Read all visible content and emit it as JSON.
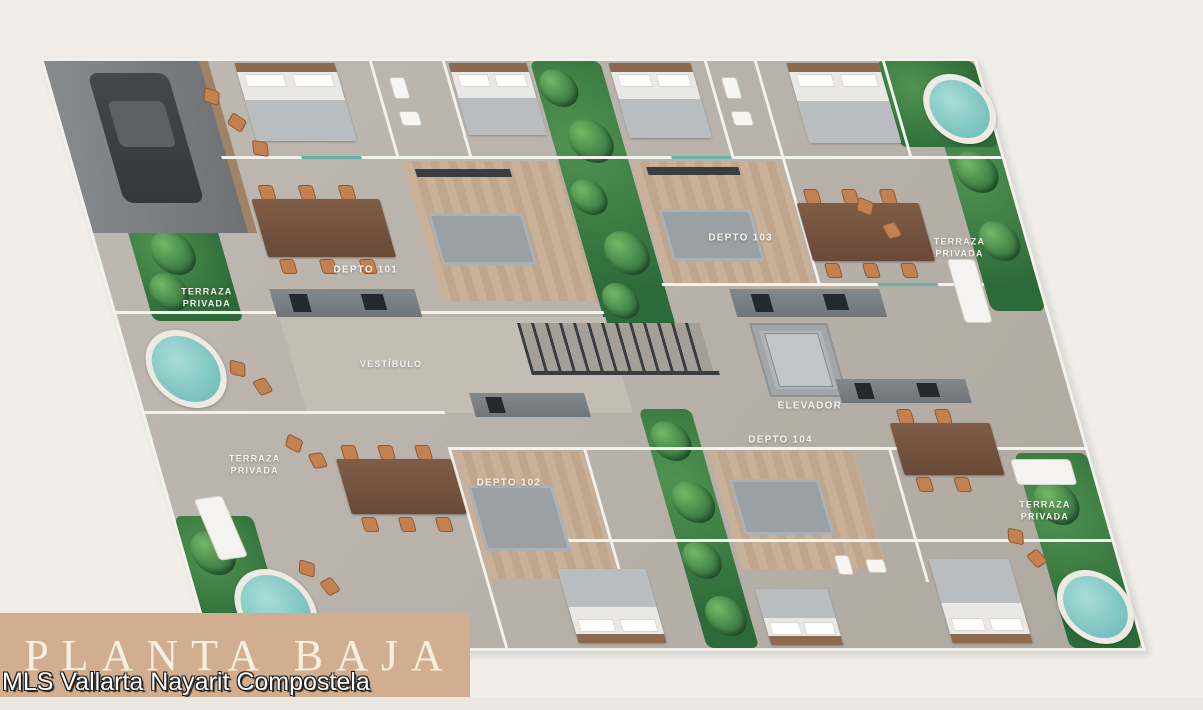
{
  "banner": {
    "title": "PLANTA BAJA",
    "color": "#d1ae8f",
    "text_color": "#f7efdf"
  },
  "watermark": {
    "text": "MLS Vallarta Nayarit Compostela"
  },
  "floorplan": {
    "units": {
      "depto_101": "DEPTO 101",
      "depto_102": "DEPTO 102",
      "depto_103": "DEPTO 103",
      "depto_104": "DEPTO 104"
    },
    "areas": {
      "vestibulo": "VESTÍBULO",
      "elevador": "ELEVADOR",
      "terraza_privada": "TERRAZA\nPRIVADA"
    },
    "colors": {
      "background": "#f0eee7",
      "floor": "#b8b2aa",
      "walls": "#f2f1ec",
      "greenery": "#3f7a47",
      "pool": "#8fd0cd",
      "wood_table": "#7a5a44",
      "wood_floor": "#c9b098"
    }
  }
}
